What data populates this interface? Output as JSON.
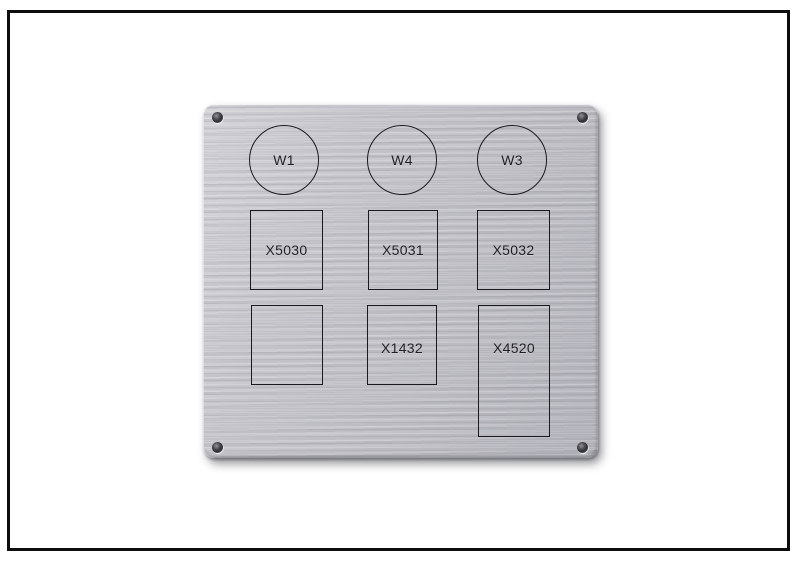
{
  "panel": {
    "circles": [
      {
        "label": "W1"
      },
      {
        "label": "W4"
      },
      {
        "label": "W3"
      }
    ],
    "middle_row": [
      {
        "label": "X5030"
      },
      {
        "label": "X5031"
      },
      {
        "label": "X5032"
      }
    ],
    "bottom_row": [
      {
        "label": ""
      },
      {
        "label": "X1432"
      },
      {
        "label": "X4520"
      }
    ],
    "colors": {
      "background": "#ffffff",
      "frame_border": "#0d0d0d",
      "plate_base": "#c3c3c9",
      "plate_highlight": "#d8d8de",
      "plate_edge_shadow": "#8e8e98",
      "engraving_line": "#1a1a1e",
      "label_text": "#1f1f23",
      "screw_hole_dark": "#2d2d32"
    }
  }
}
